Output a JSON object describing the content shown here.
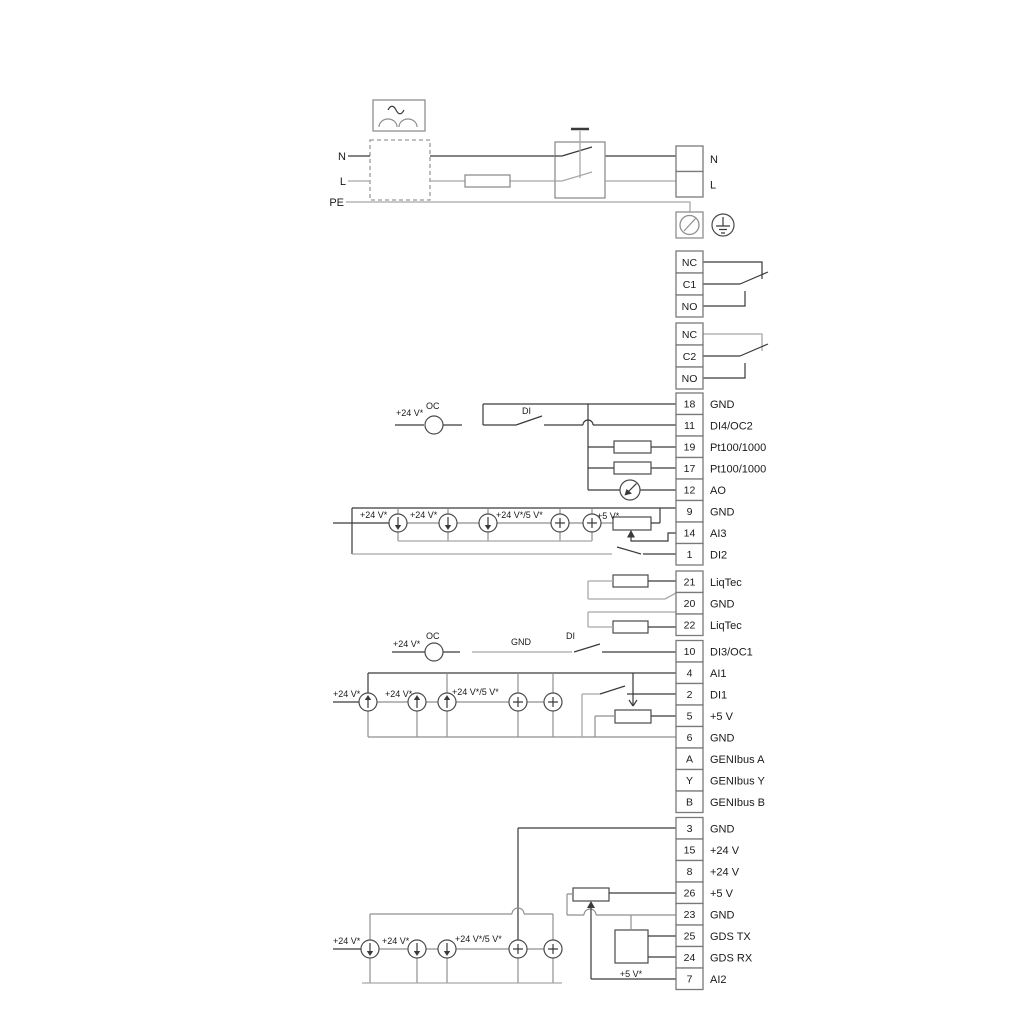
{
  "labels": {
    "n": "N",
    "l": "L",
    "pe": "PE",
    "v24": "+24 V*",
    "v24_5": "+24 V*/5 V*",
    "v5": "+5 V*",
    "oc": "OC",
    "di": "DI",
    "gnd": "GND"
  },
  "terminal_groups": {
    "power_out": {
      "rows": [
        {
          "box": "",
          "label": "N"
        },
        {
          "box": "",
          "label": "L"
        }
      ]
    },
    "relay1": {
      "rows": [
        {
          "box": "NC",
          "label": ""
        },
        {
          "box": "C1",
          "label": ""
        },
        {
          "box": "NO",
          "label": ""
        }
      ]
    },
    "relay2": {
      "rows": [
        {
          "box": "NC",
          "label": ""
        },
        {
          "box": "C2",
          "label": ""
        },
        {
          "box": "NO",
          "label": ""
        }
      ]
    },
    "io1": {
      "rows": [
        {
          "box": "18",
          "label": "GND"
        },
        {
          "box": "11",
          "label": "DI4/OC2"
        },
        {
          "box": "19",
          "label": "Pt100/1000"
        },
        {
          "box": "17",
          "label": "Pt100/1000"
        },
        {
          "box": "12",
          "label": "AO"
        },
        {
          "box": "9",
          "label": "GND"
        },
        {
          "box": "14",
          "label": "AI3"
        },
        {
          "box": "1",
          "label": "DI2"
        }
      ]
    },
    "liqtec": {
      "rows": [
        {
          "box": "21",
          "label": "LiqTec"
        },
        {
          "box": "20",
          "label": "GND"
        },
        {
          "box": "22",
          "label": "LiqTec"
        }
      ]
    },
    "io2": {
      "rows": [
        {
          "box": "10",
          "label": "DI3/OC1"
        },
        {
          "box": "4",
          "label": "AI1"
        },
        {
          "box": "2",
          "label": "DI1"
        },
        {
          "box": "5",
          "label": "+5 V"
        },
        {
          "box": "6",
          "label": "GND"
        },
        {
          "box": "A",
          "label": "GENIbus A"
        },
        {
          "box": "Y",
          "label": "GENIbus Y"
        },
        {
          "box": "B",
          "label": "GENIbus B"
        }
      ]
    },
    "io3": {
      "rows": [
        {
          "box": "3",
          "label": "GND"
        },
        {
          "box": "15",
          "label": "+24 V"
        },
        {
          "box": "8",
          "label": "+24 V"
        },
        {
          "box": "26",
          "label": "+5 V"
        },
        {
          "box": "23",
          "label": "GND"
        },
        {
          "box": "25",
          "label": "GDS TX"
        },
        {
          "box": "24",
          "label": "GDS RX"
        },
        {
          "box": "7",
          "label": "AI2"
        }
      ]
    }
  },
  "colors": {
    "wire_black": "#3a3a3a",
    "wire_gray": "#a8a8a8",
    "border_gray": "#7a7a7a"
  }
}
